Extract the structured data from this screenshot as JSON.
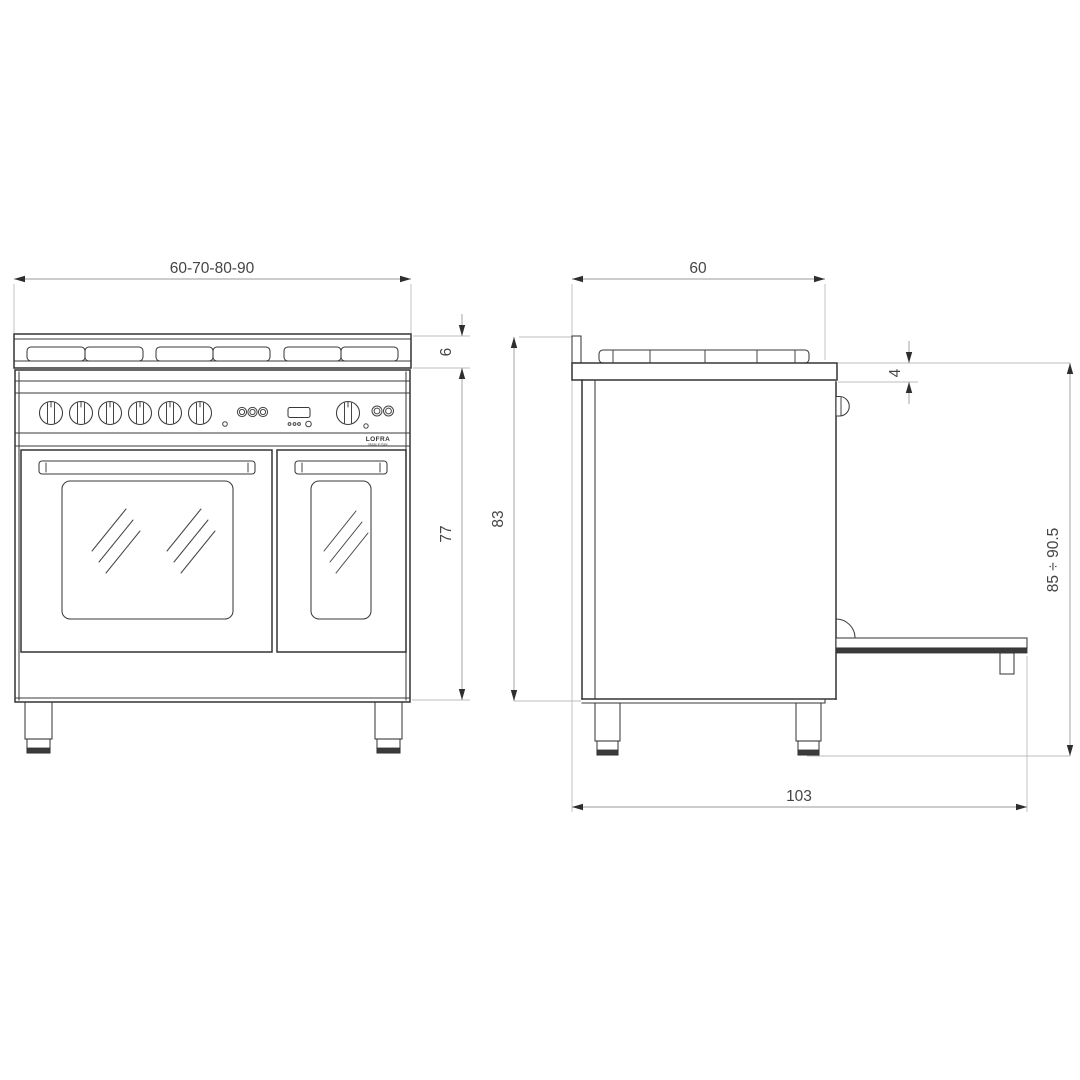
{
  "colors": {
    "background": "#ffffff",
    "drawing_line": "#333333",
    "dimension_line": "#9a9a9a",
    "extension_line": "#bdbdbd",
    "label_text": "#454545"
  },
  "front_view": {
    "width_dimension": "60-70-80-90",
    "hob_depth_dimension": "6",
    "body_height_dimension": "77",
    "brand": "LOFRA",
    "brand_subtitle": "Made in Italy"
  },
  "side_view": {
    "depth_dimension": "60",
    "worktop_offset_dimension": "4",
    "body_height_dimension": "83",
    "overall_height_dimension": "85 ÷ 90.5",
    "depth_door_open_dimension": "103"
  }
}
